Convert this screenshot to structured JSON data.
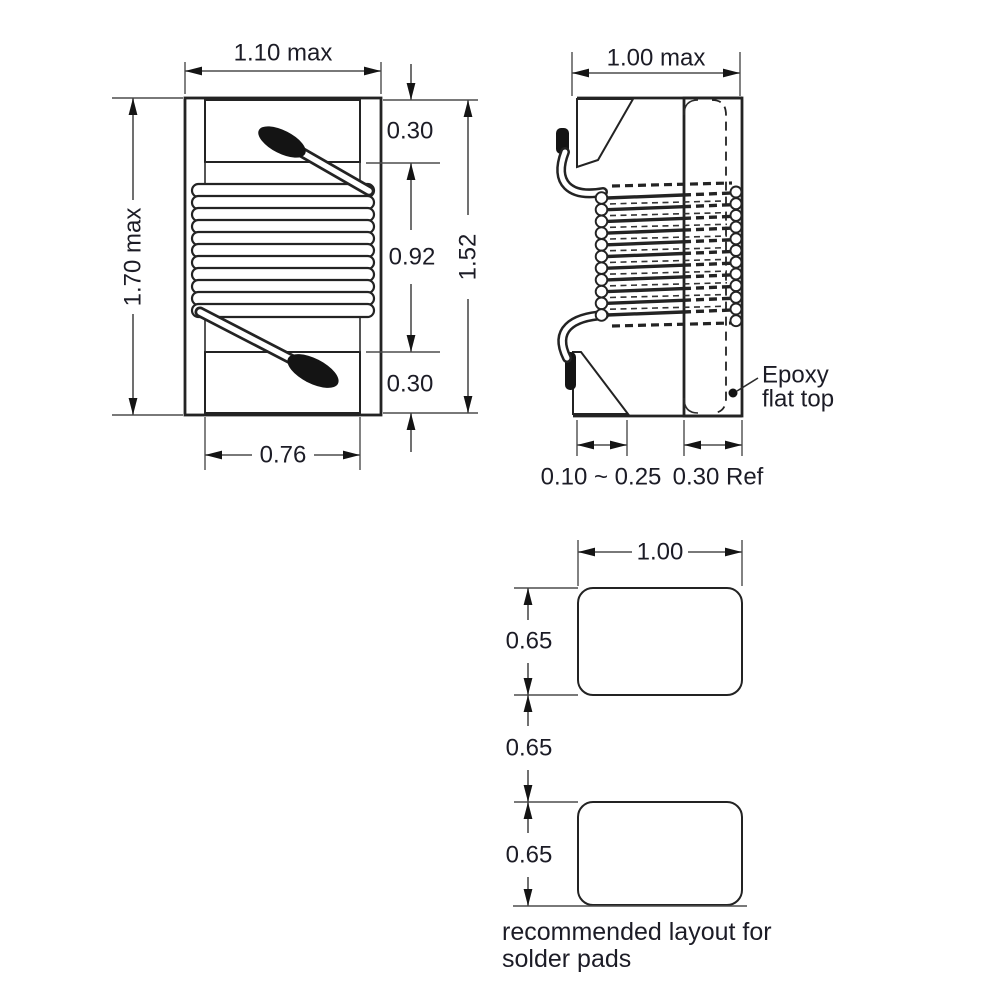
{
  "front_view": {
    "width_max": "1.10 max",
    "height_max": "1.70 max",
    "terminal_top": "0.30",
    "winding_height": "0.92",
    "terminal_bottom": "0.30",
    "body_length": "1.52",
    "terminal_width": "0.76"
  },
  "side_view": {
    "width_max": "1.00 max",
    "lead_thickness": "0.10 ~ 0.25",
    "epoxy_ref": "0.30 Ref",
    "epoxy_label_line1": "Epoxy",
    "epoxy_label_line2": "flat top"
  },
  "pad_layout": {
    "width": "1.00",
    "pad_height_top": "0.65",
    "pad_gap": "0.65",
    "pad_height_bottom": "0.65",
    "caption_line1": "recommended layout for",
    "caption_line2": "solder pads"
  },
  "colors": {
    "line": "#232323",
    "dimension": "#4d4d4d",
    "wire_end": "#141414"
  }
}
